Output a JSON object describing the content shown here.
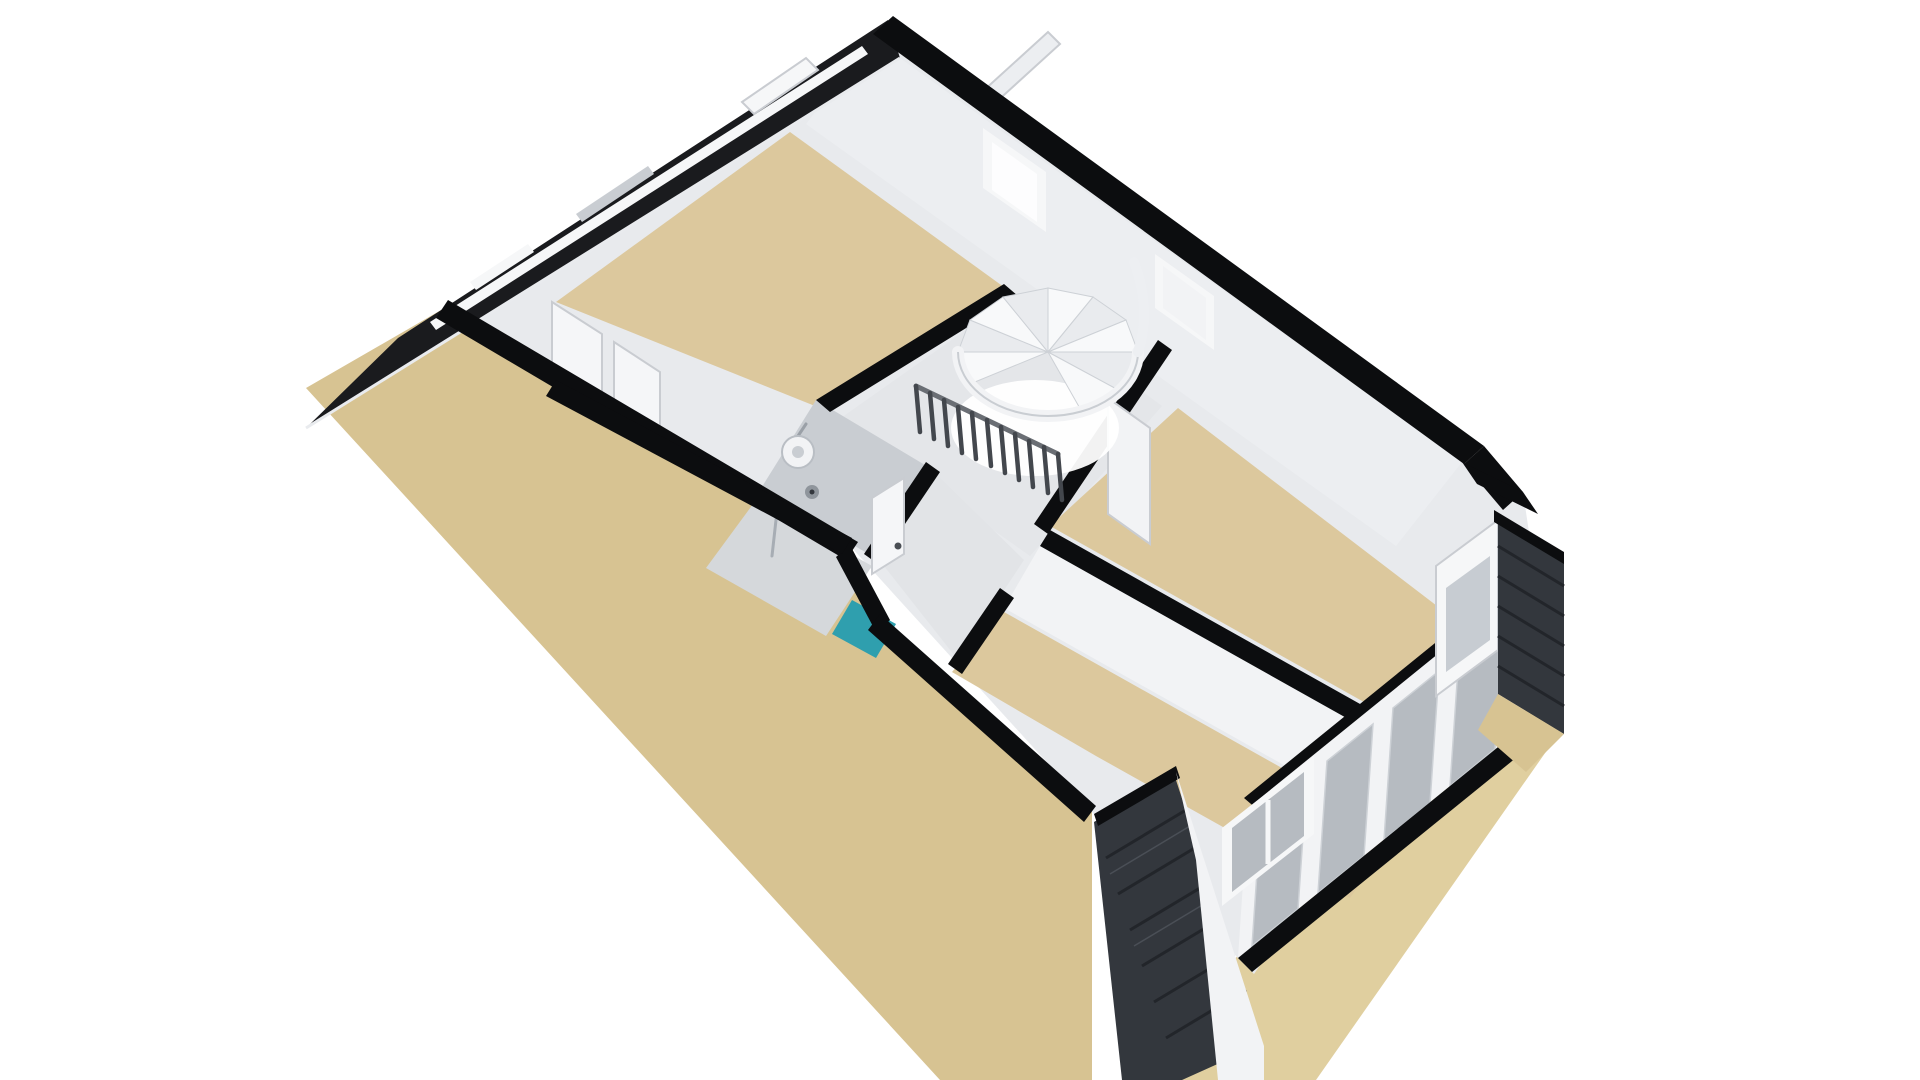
{
  "meta": {
    "type": "3d-floorplan-render",
    "view": "isometric-top-floor"
  },
  "colors": {
    "background": "#ffffff",
    "roof_dark": "#1a1b1e",
    "cap_black": "#0c0d0f",
    "tile_dark": "#33373d",
    "sand": "#d7c392",
    "sand_light": "#e0cf9f",
    "interior_base": "#e8eaed",
    "wall_face": "#eceef1",
    "wall_shadow": "#c9cdd2",
    "wall_white": "#f2f3f5",
    "white_trim": "#f6f7f8",
    "floor_tan": "#dcc89d",
    "floor_gray": "#e4e6e9",
    "hall_gray": "#e2e4e7",
    "glass_gray": "#b6bbc1",
    "glass_bright": "#fdfdfe",
    "glass_pale": "#c7ccd2",
    "teal": "#2f9fae",
    "tray_gray": "#d5d8db",
    "door_white": "#f5f6f8",
    "stair_white": "#f8f9fa",
    "stair_step_shade": "#e9ebee",
    "fixture_gray": "#8f959c",
    "fixture_dark": "#33373d",
    "glow_white": "#ffffff"
  },
  "scene": {
    "rooms": [
      "bedroom-upper",
      "stair-hall",
      "bathroom",
      "bedroom-right",
      "bedroom-bottom"
    ],
    "features": [
      "spiral-staircase",
      "stair-railing",
      "shower",
      "skylight-windows",
      "dormer-bottom",
      "dormer-right",
      "window-band-southeast"
    ]
  }
}
